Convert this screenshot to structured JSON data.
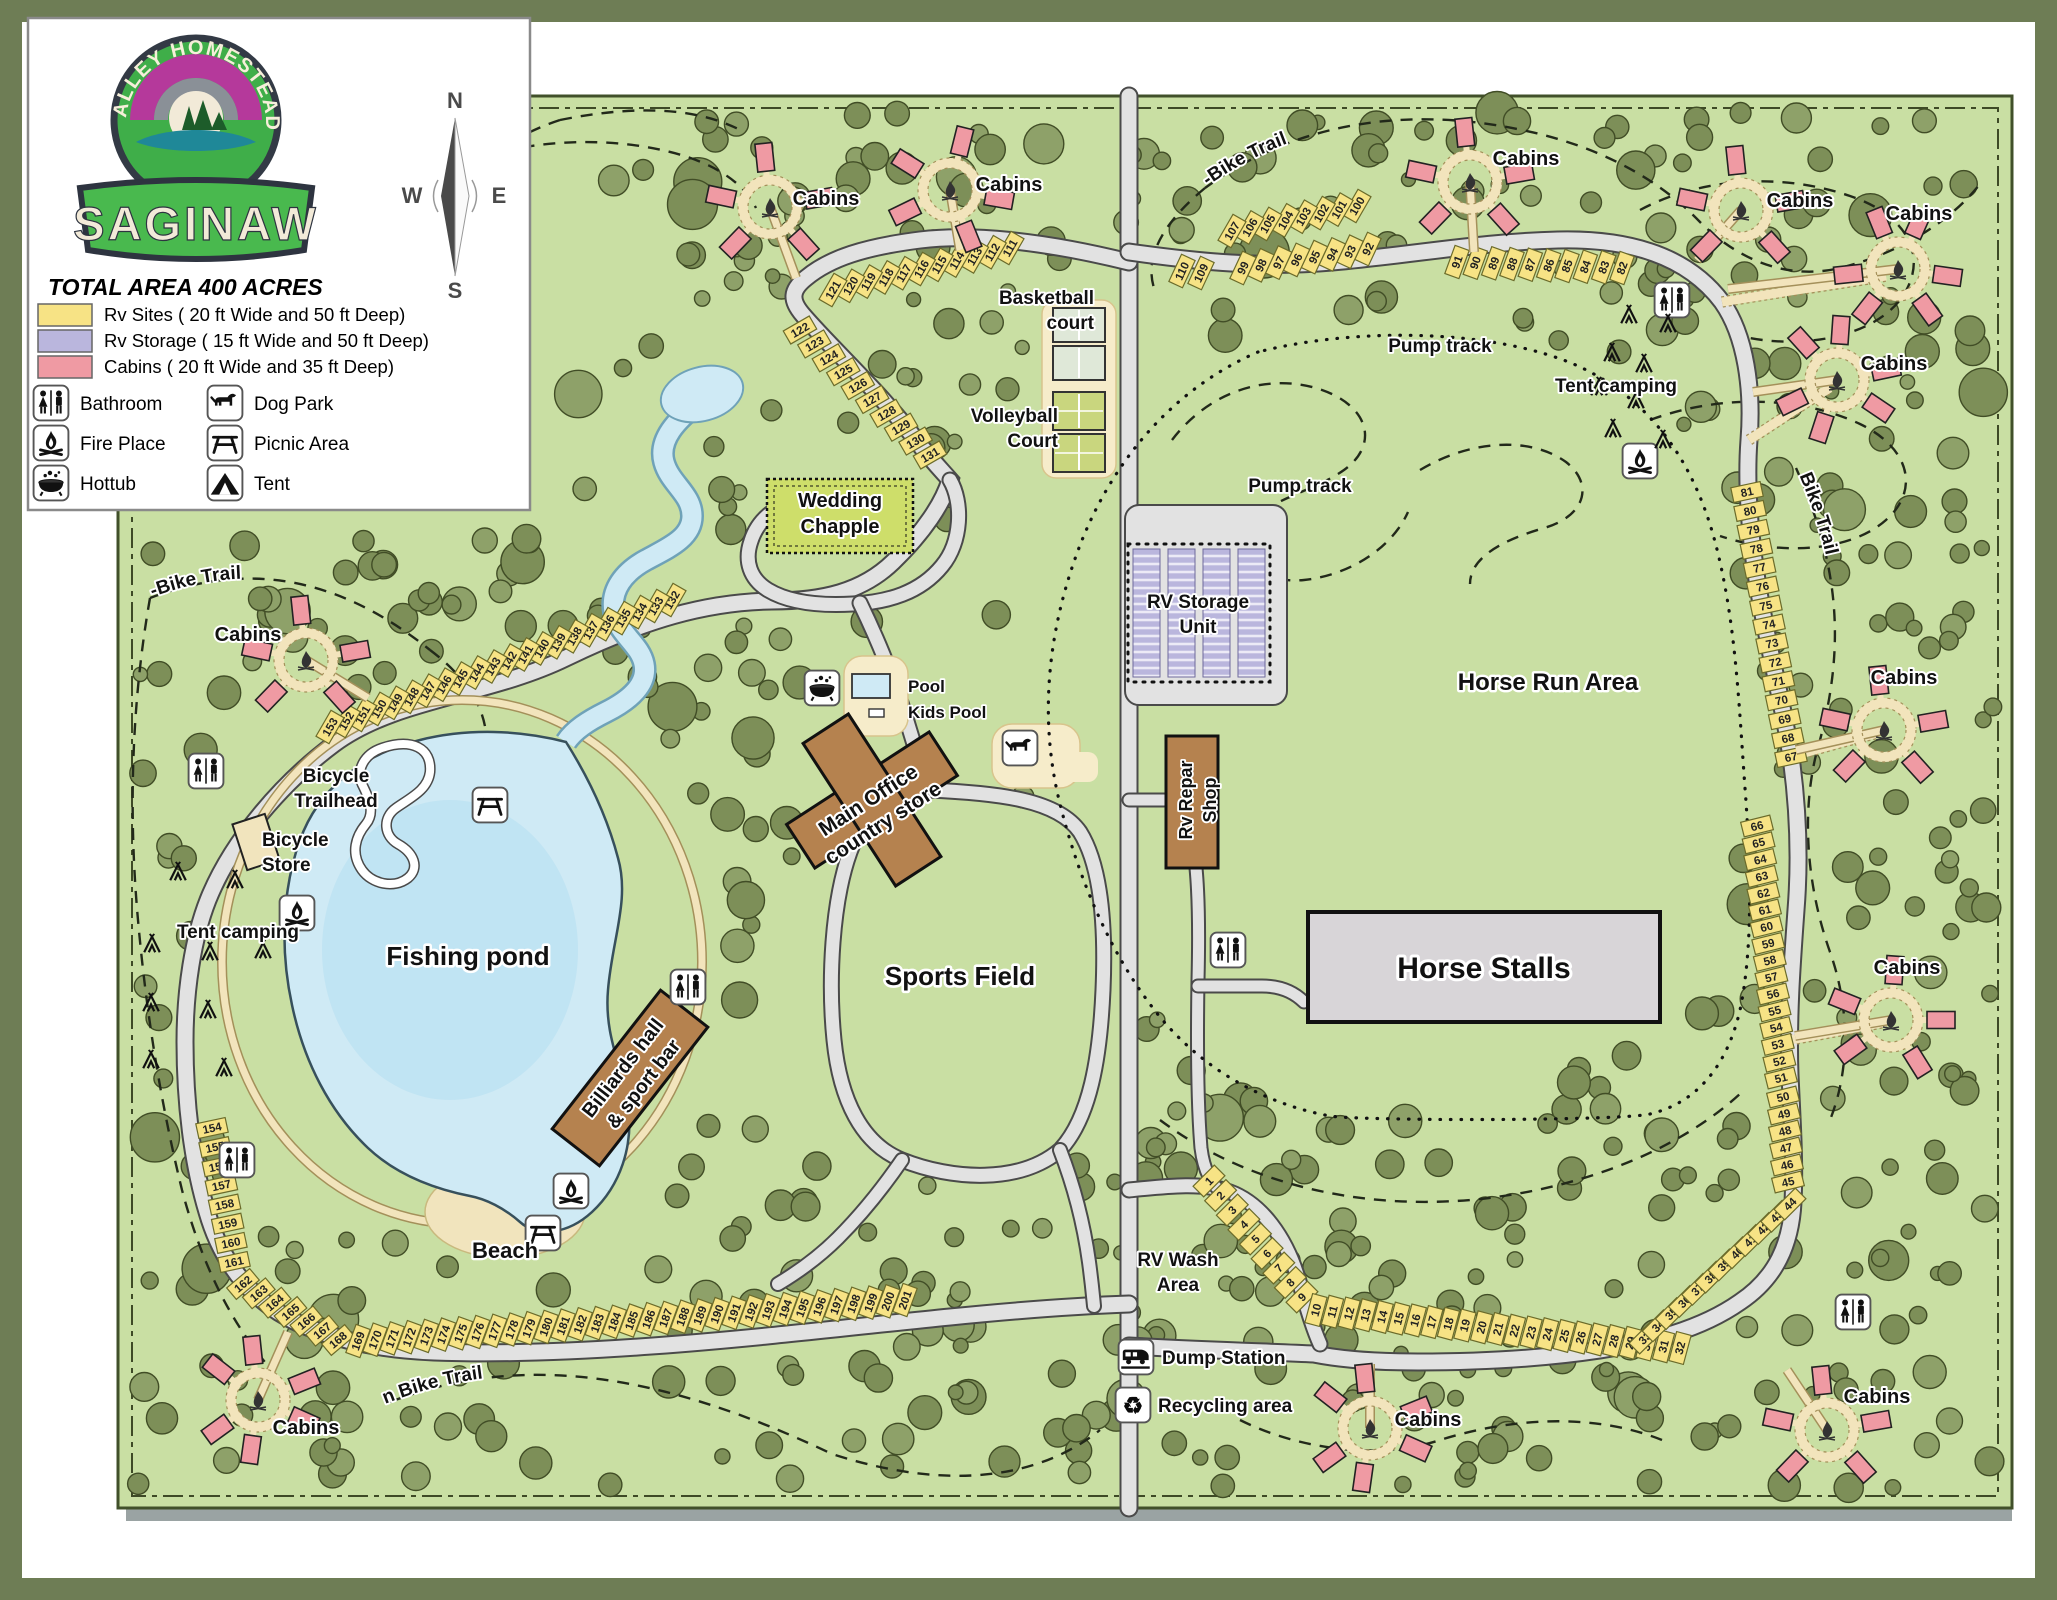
{
  "logo": {
    "arc_text": "VALLEY HOMESTEAD",
    "banner_text": "SAGINAW"
  },
  "legend": {
    "title": "TOTAL AREA 400 ACRES",
    "areas": [
      {
        "label": "Rv Sites ( 20 ft Wide and 50 ft Deep)",
        "color": "#f7e385"
      },
      {
        "label": "Rv Storage ( 15 ft Wide and 50 ft Deep)",
        "color": "#bab6dd"
      },
      {
        "label": "Cabins ( 20 ft Wide and 35 ft Deep)",
        "color": "#ef9aa3"
      }
    ],
    "amenities": [
      {
        "label": "Bathroom",
        "icon": "bathroom"
      },
      {
        "label": "Dog Park",
        "icon": "dog"
      },
      {
        "label": "Fire Place",
        "icon": "fire"
      },
      {
        "label": "Picnic Area",
        "icon": "picnic"
      },
      {
        "label": "Hottub",
        "icon": "hottub"
      },
      {
        "label": "Tent",
        "icon": "tent"
      }
    ]
  },
  "compass": {
    "north": "N",
    "south": "S",
    "east": "E",
    "west": "W"
  },
  "map": {
    "colors": {
      "outer_border": "#6e7d55",
      "map_bg": "#c9dfa3",
      "frame": "#41502a",
      "tree": "#7d8f58",
      "tree_light": "#8ea169",
      "tree_edge": "#414d26",
      "road": "#e2e2e2",
      "road_edge": "#4a4a4a",
      "trail_tan": "#f2e4bc",
      "trail_edge": "#a4905a",
      "water": "#cfeaf5",
      "water_deep": "#b5def0",
      "water_edge": "#6fa2b8",
      "sand": "#f1e4bd",
      "rv_site": "#f7e385",
      "rv_site_edge": "#6b6b2a",
      "rv_storage": "#bab6dd",
      "cabin": "#ef9aa3",
      "building": "#b5824f",
      "chapel": "#cede6a",
      "stalls": "#d8d5d8",
      "court_pad": "#f6ecca"
    },
    "labels": [
      {
        "n": "basketball-court-label",
        "L": [
          "Basketball",
          "court"
        ],
        "x": 1094,
        "y": 304,
        "s": 19,
        "a": "end"
      },
      {
        "n": "volleyball-court-label",
        "L": [
          "Volleyball",
          "Court"
        ],
        "x": 1058,
        "y": 422,
        "s": 19,
        "a": "end"
      },
      {
        "n": "wedding-chapel-label",
        "L": [
          "Wedding",
          "Chapple"
        ],
        "x": 840,
        "y": 507,
        "s": 20
      },
      {
        "n": "pool-label",
        "t": "Pool",
        "x": 908,
        "y": 692,
        "s": 17,
        "a": "start"
      },
      {
        "n": "kids-pool-label",
        "t": "Kids Pool",
        "x": 908,
        "y": 718,
        "s": 17,
        "a": "start"
      },
      {
        "n": "main-office-label",
        "L": [
          "Main Office",
          "country store"
        ],
        "x": 872,
        "y": 806,
        "s": 21,
        "r": -33
      },
      {
        "n": "sports-field-label",
        "t": "Sports Field",
        "x": 960,
        "y": 985,
        "s": 26
      },
      {
        "n": "fishing-pond-label",
        "t": "Fishing pond",
        "x": 468,
        "y": 965,
        "s": 26
      },
      {
        "n": "beach-label",
        "t": "Beach",
        "x": 505,
        "y": 1258,
        "s": 22
      },
      {
        "n": "billiards-label",
        "L": [
          "Billiards hall",
          "& sport bar"
        ],
        "x": 628,
        "y": 1072,
        "s": 20,
        "r": -52
      },
      {
        "n": "bicycle-trailhead-label",
        "L": [
          "Bicycle",
          "Trailhead"
        ],
        "x": 336,
        "y": 782,
        "s": 19
      },
      {
        "n": "bicycle-store-label",
        "L": [
          "Bicycle",
          "Store"
        ],
        "x": 262,
        "y": 846,
        "s": 19,
        "a": "start"
      },
      {
        "n": "tent-camping-left-label",
        "t": "Tent camping",
        "x": 238,
        "y": 938,
        "s": 19
      },
      {
        "n": "tent-camping-right-label",
        "t": "Tent camping",
        "x": 1616,
        "y": 392,
        "s": 19
      },
      {
        "n": "pump-track-1-label",
        "t": "Pump track",
        "x": 1440,
        "y": 352,
        "s": 19
      },
      {
        "n": "pump-track-2-label",
        "t": "Pump track",
        "x": 1300,
        "y": 492,
        "s": 19
      },
      {
        "n": "rv-storage-label",
        "L": [
          "RV Storage",
          "Unit"
        ],
        "x": 1198,
        "y": 608,
        "s": 19
      },
      {
        "n": "rv-repair-label",
        "L": [
          "Rv Repar",
          "Shop"
        ],
        "x": 1192,
        "y": 800,
        "s": 18,
        "r": -90
      },
      {
        "n": "horse-run-label",
        "t": "Horse Run Area",
        "x": 1548,
        "y": 690,
        "s": 24
      },
      {
        "n": "horse-stalls-label",
        "t": "Horse Stalls",
        "x": 1484,
        "y": 978,
        "s": 30
      },
      {
        "n": "rv-wash-label",
        "L": [
          "RV Wash",
          "Area"
        ],
        "x": 1178,
        "y": 1266,
        "s": 19
      },
      {
        "n": "dump-station-label",
        "t": "Dump Station",
        "x": 1162,
        "y": 1364,
        "s": 19,
        "a": "start"
      },
      {
        "n": "recycling-label",
        "t": "Recycling area",
        "x": 1158,
        "y": 1412,
        "s": 19,
        "a": "start"
      },
      {
        "n": "mtb-trail-left-label",
        "t": "Mountain-Bike Trail",
        "p": "mtbL",
        "s": 19
      },
      {
        "n": "mtb-trail-bottom-label",
        "t": "Mountain Bike Trail",
        "p": "mtbB",
        "s": 19
      },
      {
        "n": "mtb-trail-righttop-label",
        "t": "Mountain-Bike Trail",
        "p": "mtbRT",
        "s": 19
      },
      {
        "n": "mtb-trail-rightside-label",
        "t": "Mountain Bike Trail",
        "p": "mtbRS",
        "s": 19
      }
    ],
    "site_groups": [
      {
        "from": 111,
        "to": 121,
        "x1": 1010,
        "y1": 248,
        "x2": 833,
        "y2": 290,
        "rot": -60
      },
      {
        "from": 122,
        "to": 131,
        "x1": 800,
        "y1": 330,
        "x2": 930,
        "y2": 455,
        "rot": -30
      },
      {
        "from": 132,
        "to": 153,
        "x1": 672,
        "y1": 600,
        "x2": 330,
        "y2": 727,
        "rot": -60
      },
      {
        "from": 154,
        "to": 161,
        "x1": 212,
        "y1": 1128,
        "x2": 234,
        "y2": 1262,
        "rot": -12
      },
      {
        "from": 162,
        "to": 168,
        "x1": 243,
        "y1": 1284,
        "x2": 338,
        "y2": 1340,
        "rot": -40
      },
      {
        "from": 169,
        "to": 201,
        "x1": 358,
        "y1": 1341,
        "x2": 905,
        "y2": 1300,
        "rot": -70
      },
      {
        "from": 1,
        "to": 9,
        "x1": 1209,
        "y1": 1181,
        "x2": 1302,
        "y2": 1297,
        "rot": -45
      },
      {
        "from": 10,
        "to": 32,
        "x1": 1316,
        "y1": 1310,
        "x2": 1680,
        "y2": 1348,
        "rot": -75
      },
      {
        "from": 33,
        "to": 44,
        "x1": 1645,
        "y1": 1338,
        "x2": 1790,
        "y2": 1204,
        "rot": -45
      },
      {
        "from": 45,
        "to": 50,
        "x1": 1788,
        "y1": 1182,
        "x2": 1783,
        "y2": 1097,
        "rot": -14
      },
      {
        "from": 51,
        "to": 66,
        "x1": 1781,
        "y1": 1078,
        "x2": 1757,
        "y2": 826,
        "rot": -14
      },
      {
        "from": 67,
        "to": 81,
        "x1": 1791,
        "y1": 757,
        "x2": 1747,
        "y2": 492,
        "rot": -12
      },
      {
        "from": 82,
        "to": 91,
        "x1": 1622,
        "y1": 268,
        "x2": 1457,
        "y2": 262,
        "rot": -70
      },
      {
        "from": 92,
        "to": 99,
        "x1": 1368,
        "y1": 249,
        "x2": 1243,
        "y2": 268,
        "rot": -65
      },
      {
        "from": 100,
        "to": 107,
        "x1": 1357,
        "y1": 206,
        "x2": 1232,
        "y2": 231,
        "rot": -60
      },
      {
        "from": 109,
        "to": 110,
        "x1": 1201,
        "y1": 273,
        "x2": 1182,
        "y2": 271,
        "rot": -65
      }
    ],
    "cabin_clusters": [
      {
        "x": 770,
        "y": 207,
        "n": 5,
        "a0": -90,
        "label": {
          "t": "Cabins",
          "x": 826,
          "y": 205
        },
        "stub": [
          26,
          71
        ]
      },
      {
        "x": 950,
        "y": 190,
        "n": 5,
        "a0": -70,
        "label": {
          "t": "Cabins",
          "x": 1009,
          "y": 191
        },
        "stub": [
          10,
          60
        ]
      },
      {
        "x": 306,
        "y": 660,
        "n": 5,
        "a0": -90,
        "label": {
          "t": "Cabins",
          "x": 248,
          "y": 641
        },
        "stub": [
          62,
          38
        ]
      },
      {
        "x": 258,
        "y": 1400,
        "n": 6,
        "a0": -90,
        "label": {
          "t": "Cabins",
          "x": 306,
          "y": 1434
        },
        "stub": [
          30,
          -68
        ]
      },
      {
        "x": 1470,
        "y": 182,
        "n": 5,
        "a0": -90,
        "label": {
          "t": "Cabins",
          "x": 1526,
          "y": 165
        },
        "stub": [
          4,
          70
        ]
      },
      {
        "x": 1741,
        "y": 210,
        "n": 5,
        "a0": -90,
        "label": {
          "t": "Cabins",
          "x": 1800,
          "y": 207
        },
        "stub": [
          -44,
          50
        ]
      },
      {
        "x": 1898,
        "y": 269,
        "n": 6,
        "a0": -60,
        "label": {
          "t": "Cabins",
          "x": 1919,
          "y": 220
        },
        "stub": [
          -170,
          20
        ]
      },
      {
        "x": 1837,
        "y": 380,
        "n": 6,
        "a0": -80,
        "label": {
          "t": "Cabins",
          "x": 1894,
          "y": 370
        },
        "stub": [
          -84,
          12
        ]
      },
      {
        "x": 1884,
        "y": 730,
        "n": 5,
        "a0": -90,
        "label": {
          "t": "Cabins",
          "x": 1904,
          "y": 684
        },
        "stub": [
          -88,
          20
        ]
      },
      {
        "x": 1891,
        "y": 1020,
        "n": 5,
        "a0": -80,
        "label": {
          "t": "Cabins",
          "x": 1907,
          "y": 974
        },
        "stub": [
          -96,
          16
        ]
      },
      {
        "x": 1370,
        "y": 1428,
        "n": 6,
        "a0": -90,
        "label": {
          "t": "Cabins",
          "x": 1428,
          "y": 1426
        },
        "stub": [
          0,
          -64
        ]
      },
      {
        "x": 1827,
        "y": 1430,
        "n": 5,
        "a0": -90,
        "label": {
          "t": "Cabins",
          "x": 1877,
          "y": 1403
        },
        "stub": [
          -40,
          -60
        ]
      }
    ],
    "amenity_points": {
      "bathroom": [
        [
          206,
          771
        ],
        [
          688,
          987
        ],
        [
          237,
          1160
        ],
        [
          1228,
          950
        ],
        [
          1672,
          300
        ],
        [
          1853,
          1312
        ]
      ],
      "fire": [
        [
          297,
          913
        ],
        [
          571,
          1191
        ],
        [
          1640,
          461
        ]
      ],
      "picnic": [
        [
          490,
          805
        ],
        [
          543,
          1233
        ]
      ],
      "hottub": [
        [
          822,
          688
        ]
      ],
      "dog": [
        [
          1020,
          748
        ]
      ],
      "rv": [
        [
          1136,
          1357
        ]
      ],
      "recycle": [
        [
          1133,
          1405
        ]
      ]
    },
    "tents": [
      [
        178,
        872
      ],
      [
        235,
        880
      ],
      [
        152,
        944
      ],
      [
        210,
        952
      ],
      [
        263,
        950
      ],
      [
        151,
        1003
      ],
      [
        208,
        1010
      ],
      [
        151,
        1060
      ],
      [
        224,
        1068
      ],
      [
        1629,
        315
      ],
      [
        1668,
        324
      ],
      [
        1612,
        353
      ],
      [
        1644,
        364
      ],
      [
        1599,
        387
      ],
      [
        1636,
        400
      ],
      [
        1613,
        429
      ],
      [
        1663,
        440
      ]
    ]
  }
}
